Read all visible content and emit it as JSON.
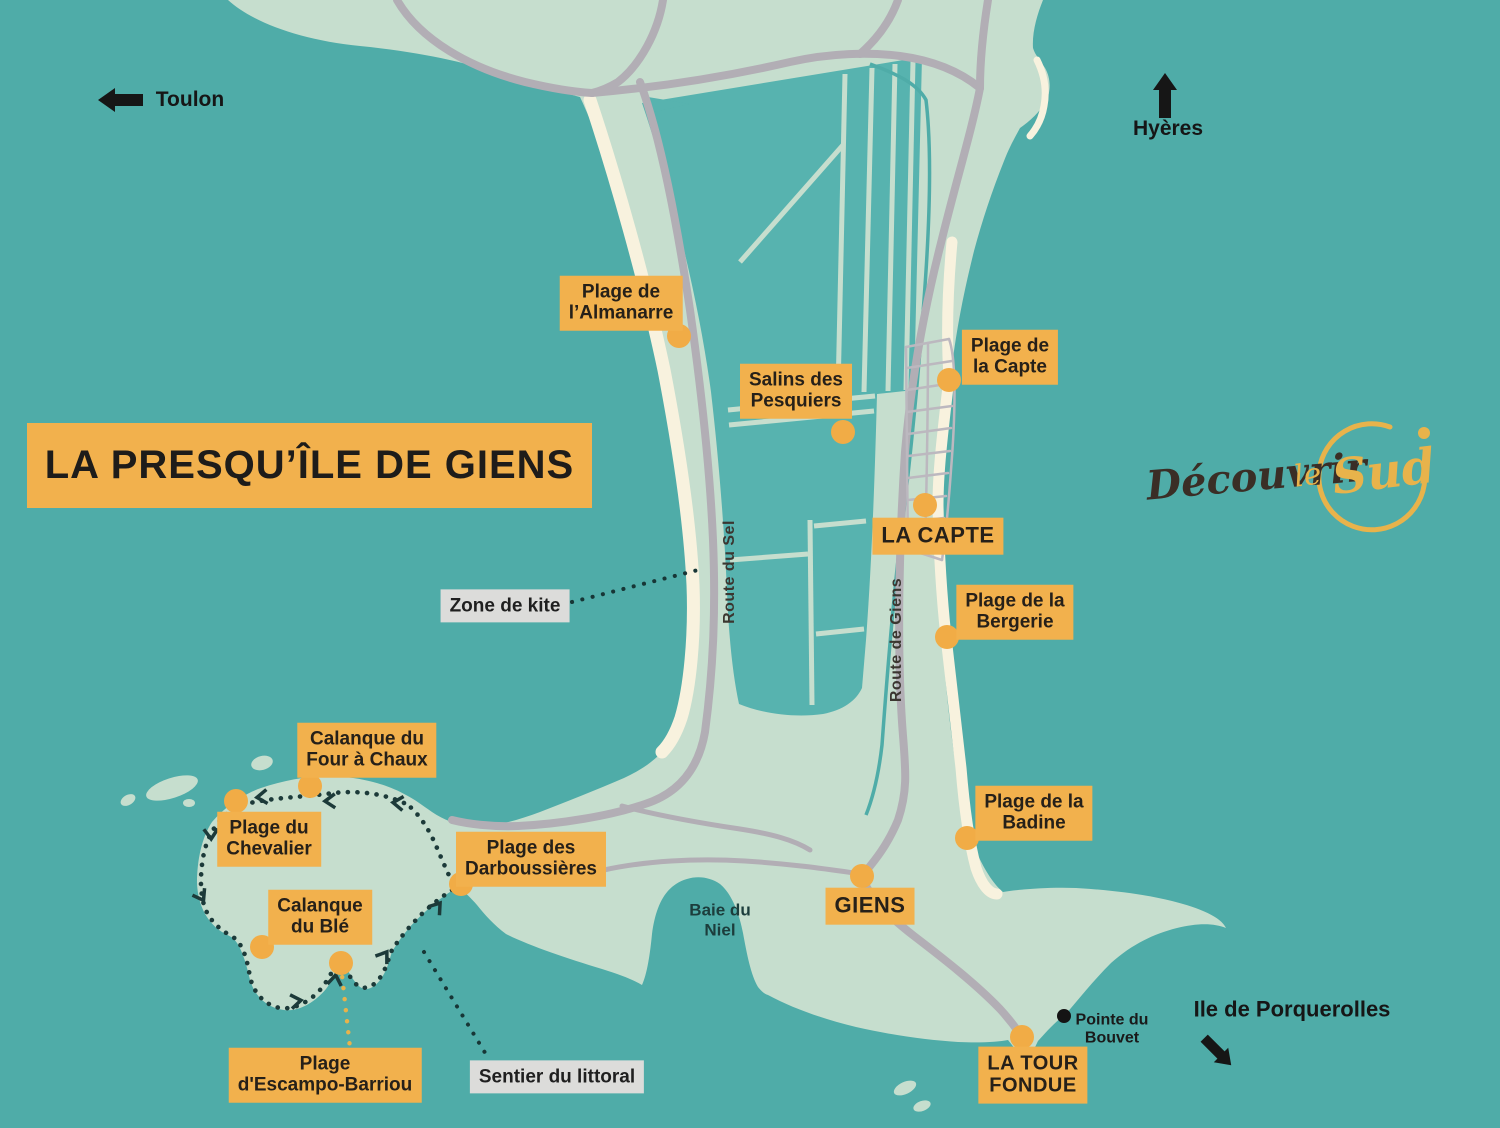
{
  "title": "LA PRESQU’ÎLE DE GIENS",
  "logo": {
    "word1": "Découvrir",
    "word2": "le",
    "word3": "Sud"
  },
  "directions": {
    "toulon": "Toulon",
    "hyeres": "Hyères",
    "porquerolles": "Ile de Porquerolles"
  },
  "labels": {
    "almanarre": {
      "l1": "Plage de",
      "l2": "l’Almanarre"
    },
    "salins": {
      "l1": "Salins des",
      "l2": "Pesquiers"
    },
    "capte_beach": {
      "l1": "Plage de",
      "l2": "la Capte"
    },
    "la_capte": {
      "l1": "LA CAPTE"
    },
    "bergerie": {
      "l1": "Plage de la",
      "l2": "Bergerie"
    },
    "badine": {
      "l1": "Plage de la",
      "l2": "Badine"
    },
    "giens": {
      "l1": "GIENS"
    },
    "tour_fondue": {
      "l1": "LA TOUR",
      "l2": "FONDUE"
    },
    "four_a_chaux": {
      "l1": "Calanque du",
      "l2": "Four à Chaux"
    },
    "chevalier": {
      "l1": "Plage du",
      "l2": "Chevalier"
    },
    "ble": {
      "l1": "Calanque",
      "l2": "du Blé"
    },
    "escampo": {
      "l1": "Plage",
      "l2": "d'Escampo-Barriou"
    },
    "darboussieres": {
      "l1": "Plage des",
      "l2": "Darboussières"
    },
    "zone_kite": {
      "l1": "Zone de kite"
    },
    "sentier": {
      "l1": "Sentier du littoral"
    },
    "baie_niel": {
      "l1": "Baie du",
      "l2": "Niel"
    },
    "pointe_bouvet": {
      "l1": "Pointe du",
      "l2": "Bouvet"
    },
    "route_sel": "Route du Sel",
    "route_giens": "Route de Giens"
  },
  "colors": {
    "sea": "#4FACA8",
    "land": "#C6DECE",
    "pond": "#57B3AF",
    "beach": "#F8F2DE",
    "road": "#B2AEB5",
    "road_minor": "#BCB8BF",
    "accent": "#F2B14D",
    "accent_dot": "#F1AC46",
    "label_text": "#262019",
    "gray_box": "#DCDCDA",
    "trail": "#1C3A39",
    "dark": "#161616",
    "logo_dark": "#3A2E26",
    "logo_gold": "#E8B34B",
    "bay_text": "#1C3D3C"
  }
}
